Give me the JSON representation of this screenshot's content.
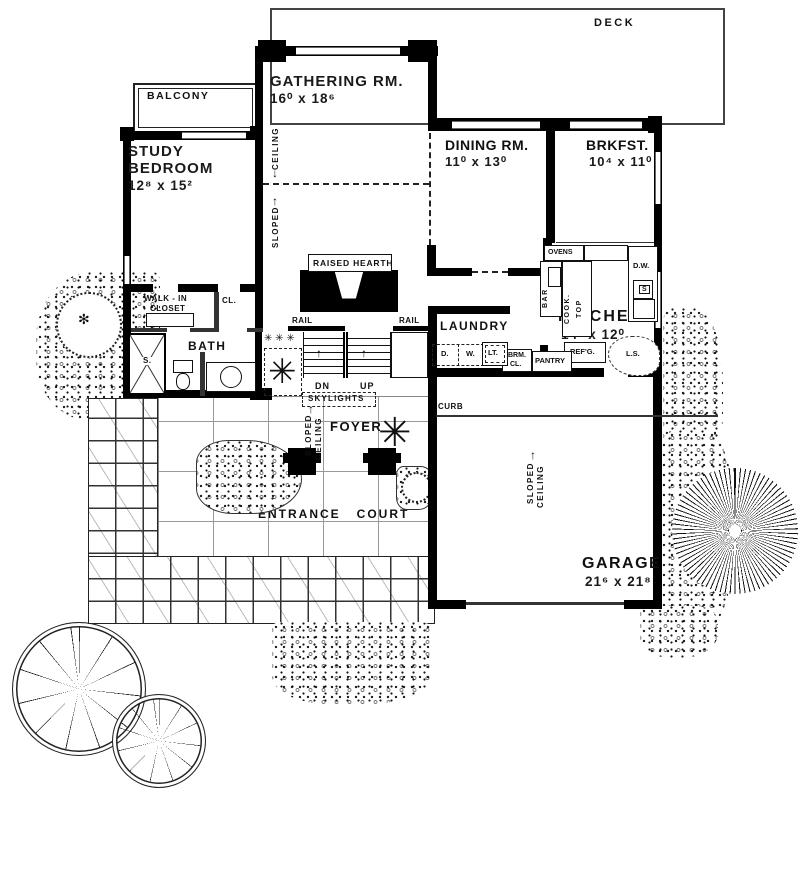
{
  "icons": {
    "arrow_up": "↑",
    "arrow_down": "↓",
    "tree_center": "✻",
    "palm": "✳",
    "stars_row": "✳ ✳ ✳"
  },
  "outdoor": {
    "deck": "DECK",
    "balcony": "BALCONY",
    "entrance_court": "ENTRANCE   COURT",
    "curb": "CURB"
  },
  "rooms": {
    "gathering": {
      "label": "GATHERING RM.",
      "dims": "16⁰ x 18⁶"
    },
    "study": {
      "line1": "STUDY",
      "line2": "BEDROOM",
      "dims": "12⁸ x 15²"
    },
    "dining": {
      "label": "DINING RM.",
      "dims": "11⁰ x 13⁰"
    },
    "brkfst": {
      "label": "BRKFST.",
      "dims": "10⁴ x 11⁰"
    },
    "kitchen": {
      "label": "KITCHEN",
      "dims": "14² x 12⁰"
    },
    "laundry": {
      "label": "LAUNDRY"
    },
    "garage": {
      "label": "GARAGE",
      "dims": "21⁶ x 21⁸"
    },
    "foyer": {
      "label": "FOYER"
    },
    "bath": {
      "label": "BATH"
    },
    "walk_in_closet": {
      "line1": "WALK - IN",
      "line2": "CLOSET"
    },
    "cl": "CL."
  },
  "features": {
    "raised_hearth": "RAISED HEARTH",
    "skylights": "SKYLIGHTS",
    "rail": "RAIL",
    "dn": "DN",
    "up": "UP",
    "sloped": "SLOPED",
    "ceiling": "CEILING",
    "shower": "S."
  },
  "kitchen_fixtures": {
    "ovens": "OVENS",
    "cook": "COOK.",
    "top": "TOP",
    "bar": "BAR",
    "dw": "D.W.",
    "sink": "S",
    "ls": "L.S.",
    "refg": "REF'G.",
    "pantry": "PANTRY",
    "brm": "BRM.",
    "brm_cl": "CL.",
    "lt": "LT.",
    "w": "W.",
    "d": "D."
  }
}
